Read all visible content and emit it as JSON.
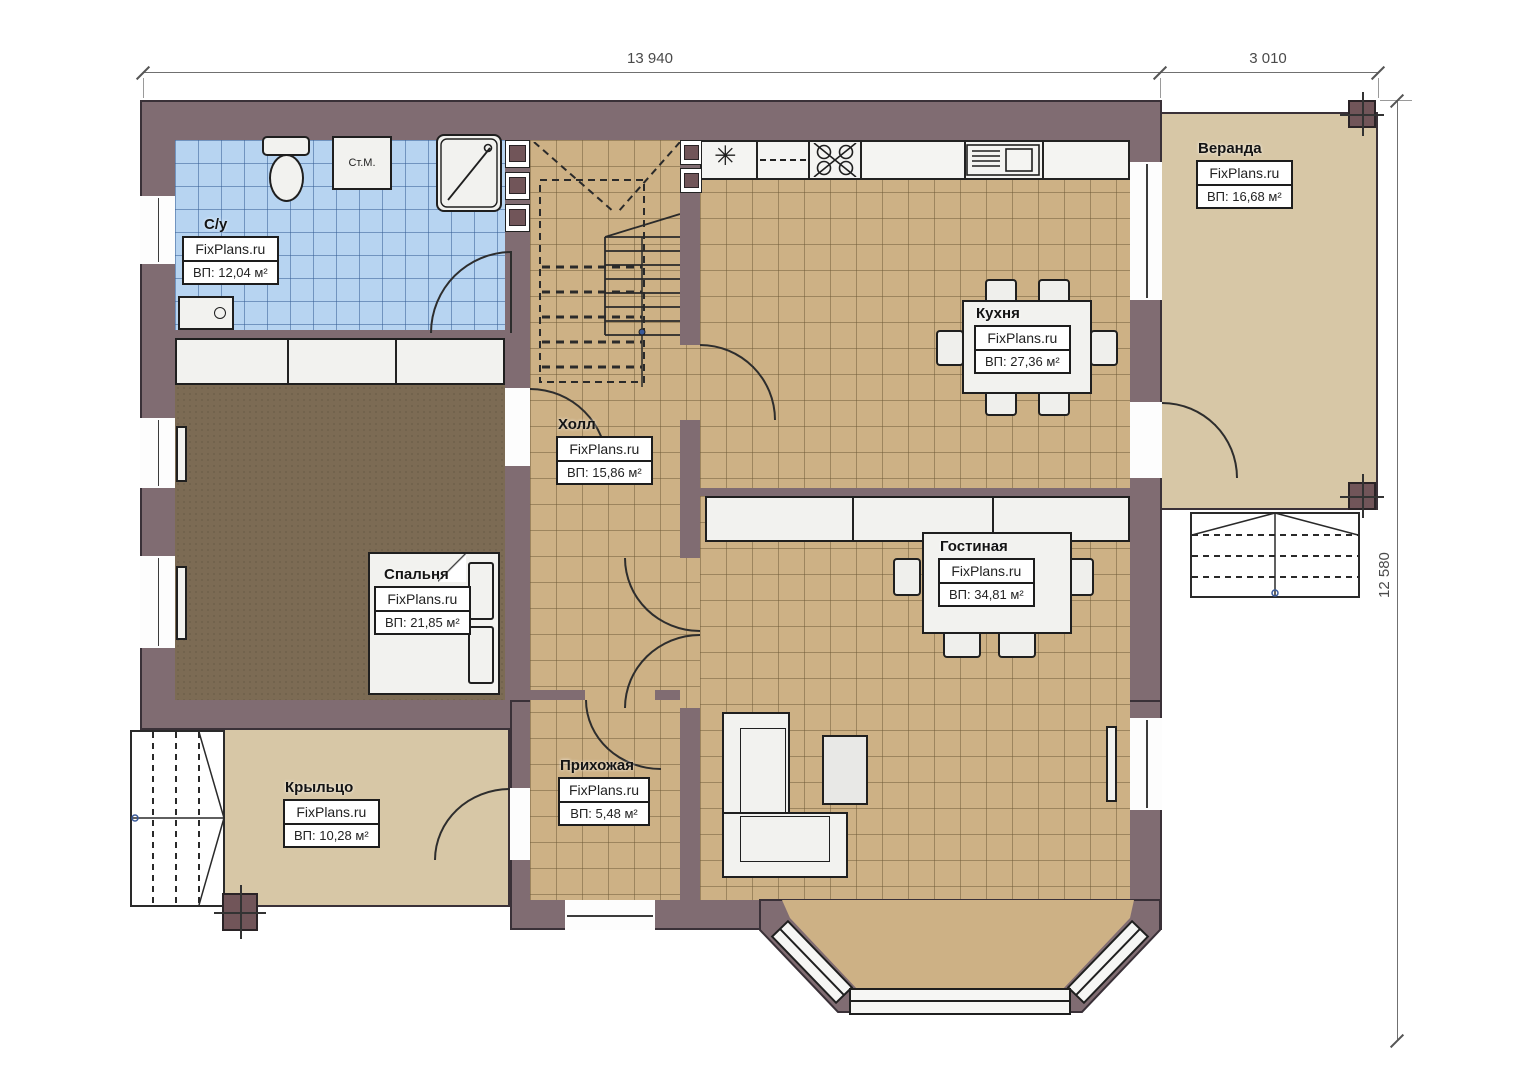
{
  "plan": {
    "watermark": "FixPlans.ru",
    "washer_label": "Ст.М.",
    "dims": {
      "width_main": "13 940",
      "width_veranda": "3 010",
      "height_total": "12 580"
    },
    "rooms": {
      "bathroom": {
        "name": "С/у",
        "area": "ВП: 12,04 м²"
      },
      "hall": {
        "name": "Холл",
        "area": "ВП: 15,86 м²"
      },
      "kitchen": {
        "name": "Кухня",
        "area": "ВП: 27,36 м²"
      },
      "living": {
        "name": "Гостиная",
        "area": "ВП: 34,81 м²"
      },
      "bedroom": {
        "name": "Спальня",
        "area": "ВП: 21,85 м²"
      },
      "entry": {
        "name": "Прихожая",
        "area": "ВП: 5,48 м²"
      },
      "porch": {
        "name": "Крыльцо",
        "area": "ВП: 10,28 м²"
      },
      "veranda": {
        "name": "Веранда",
        "area": "ВП: 16,68 м²"
      }
    },
    "colors": {
      "wall": "#806c72",
      "tile_blue": "#b7d4f1",
      "tile_tan": "#cdb185",
      "carpet": "#7c6b54",
      "deck": "#d7c7a6",
      "column": "#715559"
    }
  }
}
